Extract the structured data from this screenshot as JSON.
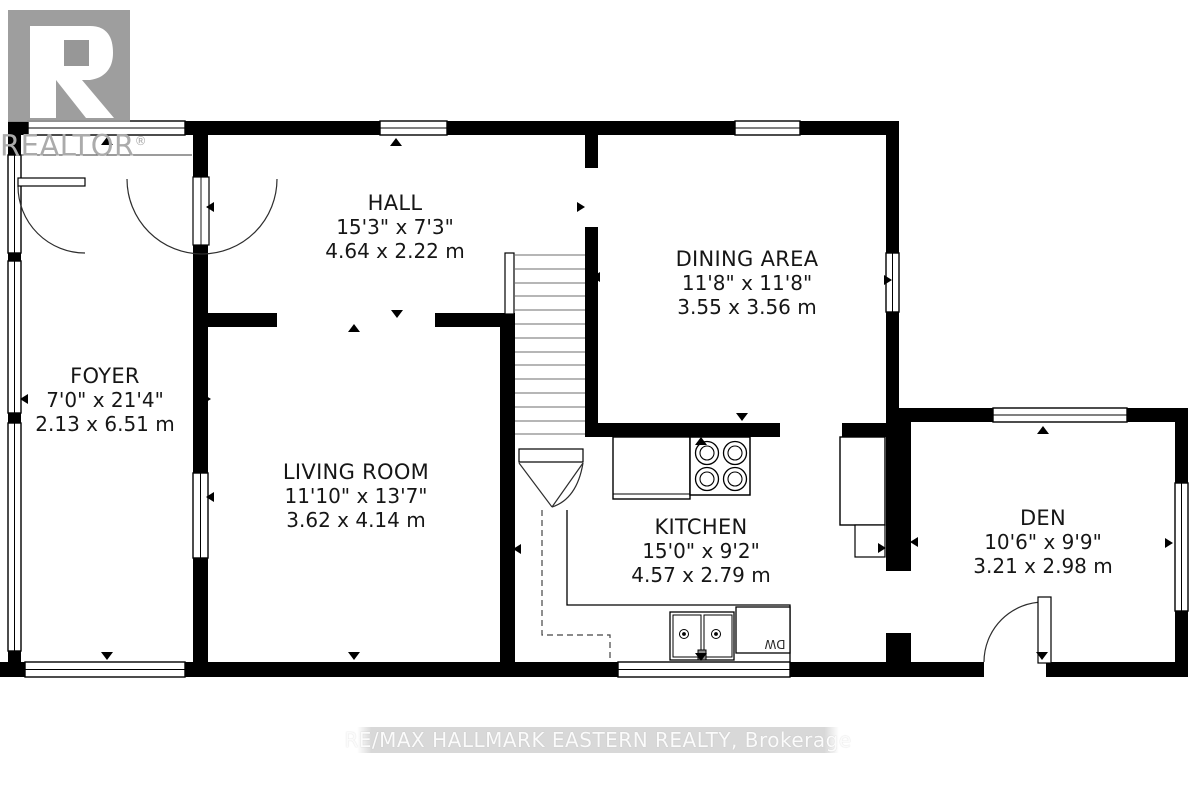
{
  "logo": {
    "letter_r": "R",
    "wordmark": "REALTOR",
    "registered": "®"
  },
  "rooms": [
    {
      "id": "hall",
      "name": "HALL",
      "imperial": "15'3\" x 7'3\"",
      "metric": "4.64 x 2.22 m"
    },
    {
      "id": "dining",
      "name": "DINING AREA",
      "imperial": "11'8\" x 11'8\"",
      "metric": "3.55 x 3.56 m"
    },
    {
      "id": "foyer",
      "name": "FOYER",
      "imperial": "7'0\" x 21'4\"",
      "metric": "2.13 x 6.51 m"
    },
    {
      "id": "living",
      "name": "LIVING ROOM",
      "imperial": "11'10\" x 13'7\"",
      "metric": "3.62 x 4.14 m"
    },
    {
      "id": "kitchen",
      "name": "KITCHEN",
      "imperial": "15'0\" x 9'2\"",
      "metric": "4.57 x 2.79 m"
    },
    {
      "id": "den",
      "name": "DEN",
      "imperial": "10'6\" x 9'9\"",
      "metric": "3.21 x 2.98 m"
    }
  ],
  "labels": {
    "dishwasher": "DW"
  },
  "watermark": {
    "text": "RE/MAX HALLMARK EASTERN REALTY, Brokerage"
  },
  "colors": {
    "wall": "#000000",
    "logo_box": "#979797",
    "logo_text": "#ababab",
    "watermark_band": "#d8d8d8",
    "watermark_text": "#fbfbfb",
    "step_line": "#8a8a8a"
  }
}
